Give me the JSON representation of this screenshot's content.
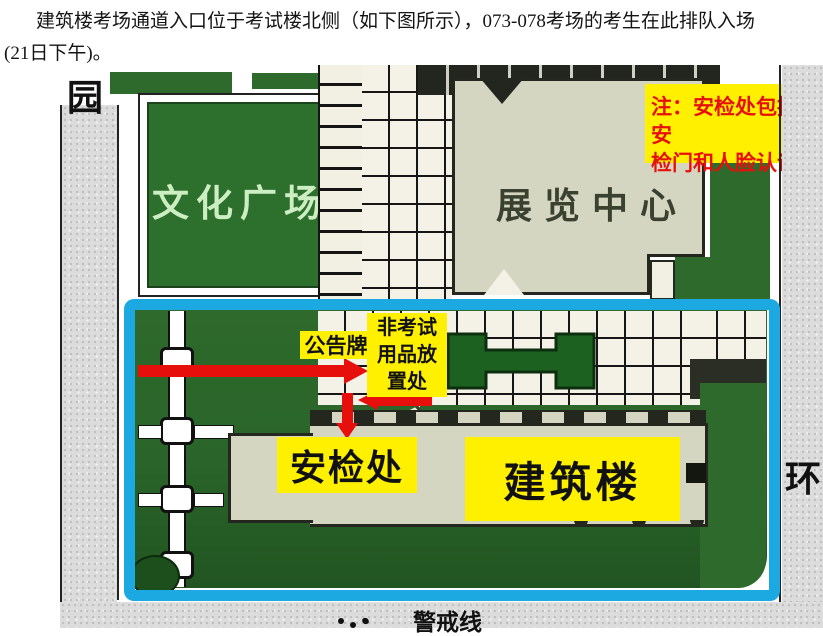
{
  "paragraph": {
    "line1": "建筑楼考场通道入口位于考试楼北侧（如下图所示），073-078考场的考生在此排队入场",
    "line2": "(21日下午)。"
  },
  "map": {
    "road_labels": {
      "top_left": "园",
      "right": "环",
      "cordon": "警戒线"
    },
    "areas": {
      "culture_plaza": "文化广场",
      "exhibition_center": "展览中心",
      "building": "建筑楼",
      "security_check": "安检处",
      "notice_board": "公告牌",
      "non_exam_items_lines": [
        "非考试",
        "用品放",
        "置处"
      ]
    },
    "note": {
      "line1": "注：安检处包括安",
      "line2": "检门和人脸认证"
    },
    "colors": {
      "highlight_cyan": "#1ca9e2",
      "label_yellow": "#fff000",
      "note_text_red": "#e60f0c",
      "arrow_red": "#e60f0c",
      "lawn_green": "#2e6a2b",
      "garden_green": "#1c611f",
      "building_beige": "#d4d6c1",
      "plaza_text_green": "#cdeec2"
    }
  }
}
